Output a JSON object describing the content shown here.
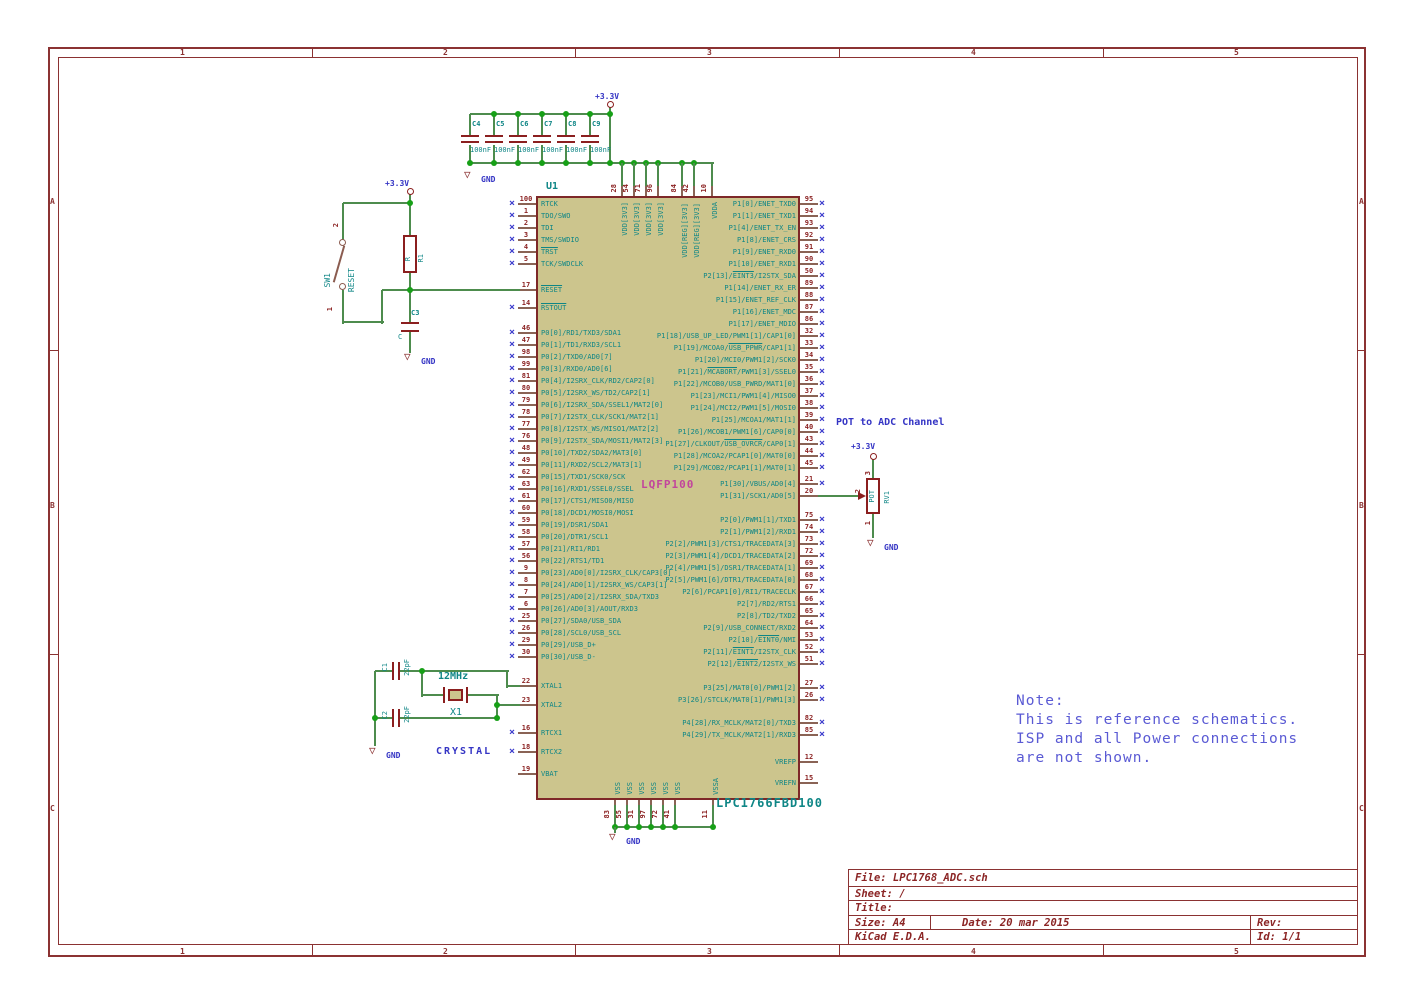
{
  "frame": {
    "columns": [
      "1",
      "2",
      "3",
      "4",
      "5"
    ],
    "rows": [
      "A",
      "B",
      "C"
    ]
  },
  "power": {
    "v33": "+3.3V",
    "gnd": "GND"
  },
  "decoupling": {
    "caps": [
      "C4",
      "C5",
      "C6",
      "C7",
      "C8",
      "C9"
    ],
    "value": "100nF"
  },
  "reset": {
    "sw_ref": "SW1",
    "sw_val": "RESET",
    "sw_pin_top": "2",
    "sw_pin_bottom": "1",
    "r_ref": "R1",
    "r_val": "R",
    "c_ref": "C3",
    "c_val": "C"
  },
  "crystal": {
    "c1_ref": "C1",
    "c1_val": "22pF",
    "c2_ref": "C2",
    "c2_val": "22pF",
    "x_ref": "X1",
    "x_val": "12MHz",
    "caption": "CRYSTAL"
  },
  "pot": {
    "caption": "POT to ADC Channel",
    "ref": "RV1",
    "value": "POT",
    "pin_top": "3",
    "pin_mid": "2",
    "pin_bottom": "1"
  },
  "ic": {
    "ref": "U1",
    "package": "LQFP100",
    "part": "LPC1766FBD100",
    "left": [
      [
        "100",
        "RTCK",
        204,
        1
      ],
      [
        "1",
        "TDO/SWO",
        216,
        1
      ],
      [
        "2",
        "TDI",
        228,
        1
      ],
      [
        "3",
        "TMS/SWDIO",
        240,
        1
      ],
      [
        "4",
        "~TRST~",
        252,
        1
      ],
      [
        "5",
        "TCK/SWDCLK",
        264,
        1
      ],
      [
        "17",
        "~RESET~",
        290,
        0
      ],
      [
        "14",
        "~RSTOUT~",
        308,
        1
      ],
      [
        "46",
        "P0[0]/RD1/TXD3/SDA1",
        333,
        1
      ],
      [
        "47",
        "P0[1]/TD1/RXD3/SCL1",
        345,
        1
      ],
      [
        "98",
        "P0[2]/TXD0/AD0[7]",
        357,
        1
      ],
      [
        "99",
        "P0[3]/RXD0/AD0[6]",
        369,
        1
      ],
      [
        "81",
        "P0[4]/I2SRX_CLK/RD2/CAP2[0]",
        381,
        1
      ],
      [
        "80",
        "P0[5]/I2SRX_WS/TD2/CAP2[1]",
        393,
        1
      ],
      [
        "79",
        "P0[6]/I2SRX_SDA/SSEL1/MAT2[0]",
        405,
        1
      ],
      [
        "78",
        "P0[7]/I2STX_CLK/SCK1/MAT2[1]",
        417,
        1
      ],
      [
        "77",
        "P0[8]/I2STX_WS/MISO1/MAT2[2]",
        429,
        1
      ],
      [
        "76",
        "P0[9]/I2STX_SDA/MOSI1/MAT2[3]",
        441,
        1
      ],
      [
        "48",
        "P0[10]/TXD2/SDA2/MAT3[0]",
        453,
        1
      ],
      [
        "49",
        "P0[11]/RXD2/SCL2/MAT3[1]",
        465,
        1
      ],
      [
        "62",
        "P0[15]/TXD1/SCK0/SCK",
        477,
        1
      ],
      [
        "63",
        "P0[16]/RXD1/SSEL0/SSEL",
        489,
        1
      ],
      [
        "61",
        "P0[17]/CTS1/MISO0/MISO",
        501,
        1
      ],
      [
        "60",
        "P0[18]/DCD1/MOSI0/MOSI",
        513,
        1
      ],
      [
        "59",
        "P0[19]/DSR1/SDA1",
        525,
        1
      ],
      [
        "58",
        "P0[20]/DTR1/SCL1",
        537,
        1
      ],
      [
        "57",
        "P0[21]/RI1/RD1",
        549,
        1
      ],
      [
        "56",
        "P0[22]/RTS1/TD1",
        561,
        1
      ],
      [
        "9",
        "P0[23]/AD0[0]/I2SRX_CLK/CAP3[0]",
        573,
        1
      ],
      [
        "8",
        "P0[24]/AD0[1]/I2SRX_WS/CAP3[1]",
        585,
        1
      ],
      [
        "7",
        "P0[25]/AD0[2]/I2SRX_SDA/TXD3",
        597,
        1
      ],
      [
        "6",
        "P0[26]/AD0[3]/AOUT/RXD3",
        609,
        1
      ],
      [
        "25",
        "P0[27]/SDA0/USB_SDA",
        621,
        1
      ],
      [
        "26",
        "P0[28]/SCL0/USB_SCL",
        633,
        1
      ],
      [
        "29",
        "P0[29]/USB_D+",
        645,
        1
      ],
      [
        "30",
        "P0[30]/USB_D-",
        657,
        1
      ],
      [
        "22",
        "XTAL1",
        686,
        0
      ],
      [
        "23",
        "XTAL2",
        705,
        0
      ],
      [
        "16",
        "RTCX1",
        733,
        1
      ],
      [
        "18",
        "RTCX2",
        752,
        1
      ],
      [
        "19",
        "VBAT",
        774,
        0
      ]
    ],
    "right": [
      [
        "95",
        "P1[0]/ENET_TXD0",
        204,
        1
      ],
      [
        "94",
        "P1[1]/ENET_TXD1",
        216,
        1
      ],
      [
        "93",
        "P1[4]/ENET_TX_EN",
        228,
        1
      ],
      [
        "92",
        "P1[8]/ENET_CRS",
        240,
        1
      ],
      [
        "91",
        "P1[9]/ENET_RXD0",
        252,
        1
      ],
      [
        "90",
        "P1[10]/ENET_RXD1",
        264,
        1
      ],
      [
        "50",
        "P2[13]/~EINT3~/I2STX_SDA",
        276,
        1
      ],
      [
        "89",
        "P1[14]/ENET_RX_ER",
        288,
        1
      ],
      [
        "88",
        "P1[15]/ENET_REF_CLK",
        300,
        1
      ],
      [
        "87",
        "P1[16]/ENET_MDC",
        312,
        1
      ],
      [
        "86",
        "P1[17]/ENET_MDIO",
        324,
        1
      ],
      [
        "32",
        "P1[18]/USB_UP_LED/PWM1[1]/CAP1[0]",
        336,
        1
      ],
      [
        "33",
        "P1[19]/MCOA0/~USB_PPWR~/CAP1[1]",
        348,
        1
      ],
      [
        "34",
        "P1[20]/MCI0/PWM1[2]/SCK0",
        360,
        1
      ],
      [
        "35",
        "P1[21]/~MCABORT~/PWM1[3]/SSEL0",
        372,
        1
      ],
      [
        "36",
        "P1[22]/MCOB0/USB_PWRD/MAT1[0]",
        384,
        1
      ],
      [
        "37",
        "P1[23]/MCI1/PWM1[4]/MISO0",
        396,
        1
      ],
      [
        "38",
        "P1[24]/MCI2/PWM1[5]/MOSI0",
        408,
        1
      ],
      [
        "39",
        "P1[25]/MCOA1/MAT1[1]",
        420,
        1
      ],
      [
        "40",
        "P1[26]/MCOB1/PWM1[6]/CAP0[0]",
        432,
        1
      ],
      [
        "43",
        "P1[27]/CLKOUT/~USB_OVRCR~/CAP0[1]",
        444,
        1
      ],
      [
        "44",
        "P1[28]/MCOA2/PCAP1[0]/MAT0[0]",
        456,
        1
      ],
      [
        "45",
        "P1[29]/MCOB2/PCAP1[1]/MAT0[1]",
        468,
        1
      ],
      [
        "21",
        "P1[30]/VBUS/AD0[4]",
        484,
        1
      ],
      [
        "20",
        "P1[31]/SCK1/AD0[5]",
        496,
        0
      ],
      [
        "75",
        "P2[0]/PWM1[1]/TXD1",
        520,
        1
      ],
      [
        "74",
        "P2[1]/PWM1[2]/RXD1",
        532,
        1
      ],
      [
        "73",
        "P2[2]/PWM1[3]/CTS1/TRACEDATA[3]",
        544,
        1
      ],
      [
        "72",
        "P2[3]/PWM1[4]/DCD1/TRACEDATA[2]",
        556,
        1
      ],
      [
        "69",
        "P2[4]/PWM1[5]/DSR1/TRACEDATA[1]",
        568,
        1
      ],
      [
        "68",
        "P2[5]/PWM1[6]/DTR1/TRACEDATA[0]",
        580,
        1
      ],
      [
        "67",
        "P2[6]/PCAP1[0]/RI1/TRACECLK",
        592,
        1
      ],
      [
        "66",
        "P2[7]/RD2/RTS1",
        604,
        1
      ],
      [
        "65",
        "P2[8]/TD2/TXD2",
        616,
        1
      ],
      [
        "64",
        "P2[9]/USB_CONNECT/RXD2",
        628,
        1
      ],
      [
        "53",
        "P2[10]/~EINT0~/NMI",
        640,
        1
      ],
      [
        "52",
        "P2[11]/~EINT1~/I2STX_CLK",
        652,
        1
      ],
      [
        "51",
        "P2[12]/~EINT2~/I2STX_WS",
        664,
        1
      ],
      [
        "27",
        "P3[25]/MAT0[0]/PWM1[2]",
        688,
        1
      ],
      [
        "26",
        "P3[26]/STCLK/MAT0[1]/PWM1[3]",
        700,
        1
      ],
      [
        "82",
        "P4[28]/RX_MCLK/MAT2[0]/TXD3",
        723,
        1
      ],
      [
        "85",
        "P4[29]/TX_MCLK/MAT2[1]/RXD3",
        735,
        1
      ],
      [
        "12",
        "VREFP",
        762,
        0
      ],
      [
        "15",
        "VREFN",
        783,
        0
      ]
    ],
    "top": [
      [
        "28",
        "VDD[3V3]",
        622
      ],
      [
        "54",
        "VDD[3V3]",
        634
      ],
      [
        "71",
        "VDD[3V3]",
        646
      ],
      [
        "96",
        "VDD[3V3]",
        658
      ],
      [
        "84",
        "VDD[REG][3V3]",
        682
      ],
      [
        "42",
        "VDD[REG][3V3]",
        694
      ],
      [
        "10",
        "VDDA",
        712
      ]
    ],
    "bottom": [
      [
        "83",
        "VSS",
        615
      ],
      [
        "55",
        "VSS",
        627
      ],
      [
        "31",
        "VSS",
        639
      ],
      [
        "97",
        "VSS",
        651
      ],
      [
        "72",
        "VSS",
        663
      ],
      [
        "41",
        "VSS",
        675
      ],
      [
        "11",
        "VSSA",
        713
      ]
    ]
  },
  "note": {
    "lines": [
      "Note:",
      "This is reference schematics.",
      "ISP and all Power connections",
      "are not shown."
    ]
  },
  "title_block": {
    "file": "File: LPC1768_ADC.sch",
    "sheet": "Sheet: /",
    "title": "Title:",
    "size": "Size: A4",
    "date": "Date: 20 mar 2015",
    "rev": "Rev:",
    "brand": "KiCad E.D.A.",
    "id": "Id: 1/1"
  }
}
